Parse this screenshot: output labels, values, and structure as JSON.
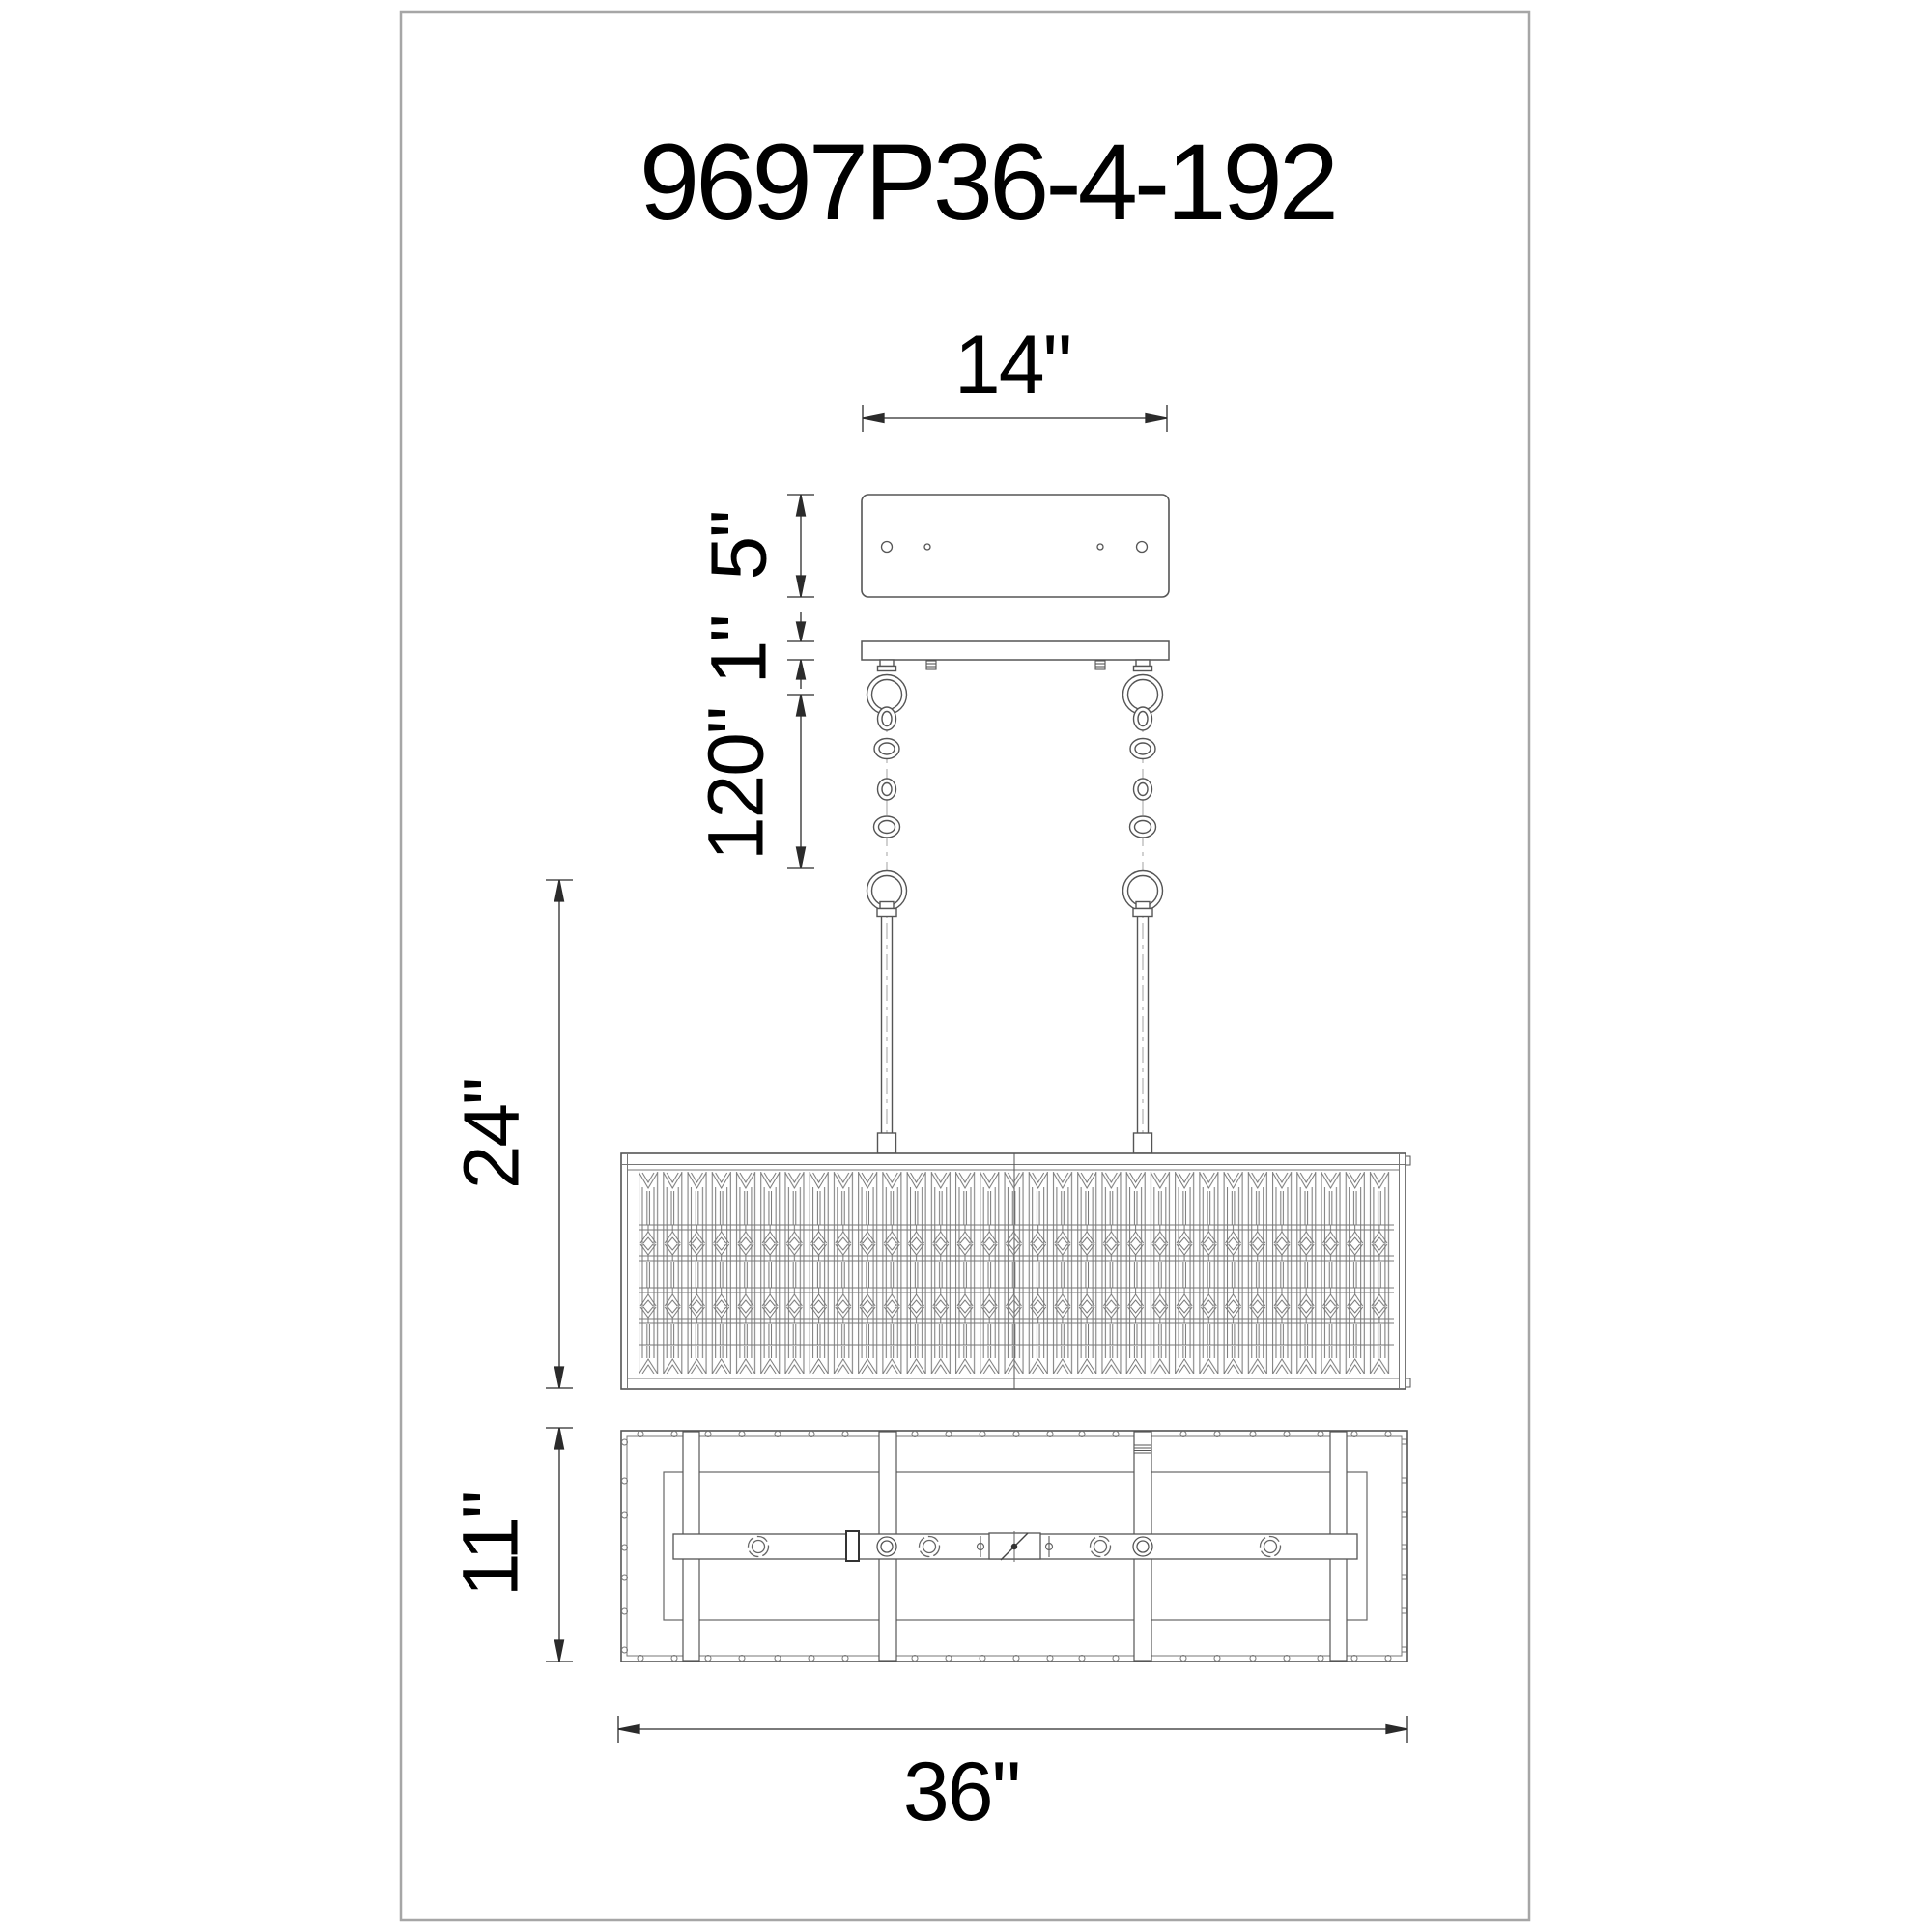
{
  "drawing": {
    "title": "9697P36-4-192",
    "labels": {
      "canopy_width": "14\"",
      "canopy_height": "5\"",
      "canopy_gap": "1\"",
      "overall_drop": "120\"",
      "body_height": "24\"",
      "fixture_depth": "11\"",
      "fixture_width": "36\""
    },
    "colors": {
      "line": "#555555",
      "detail_line": "#777777",
      "dimension_line": "#2b2b2b",
      "text": "#000000",
      "frame": "#a6a6a6",
      "background": "#ffffff"
    }
  }
}
